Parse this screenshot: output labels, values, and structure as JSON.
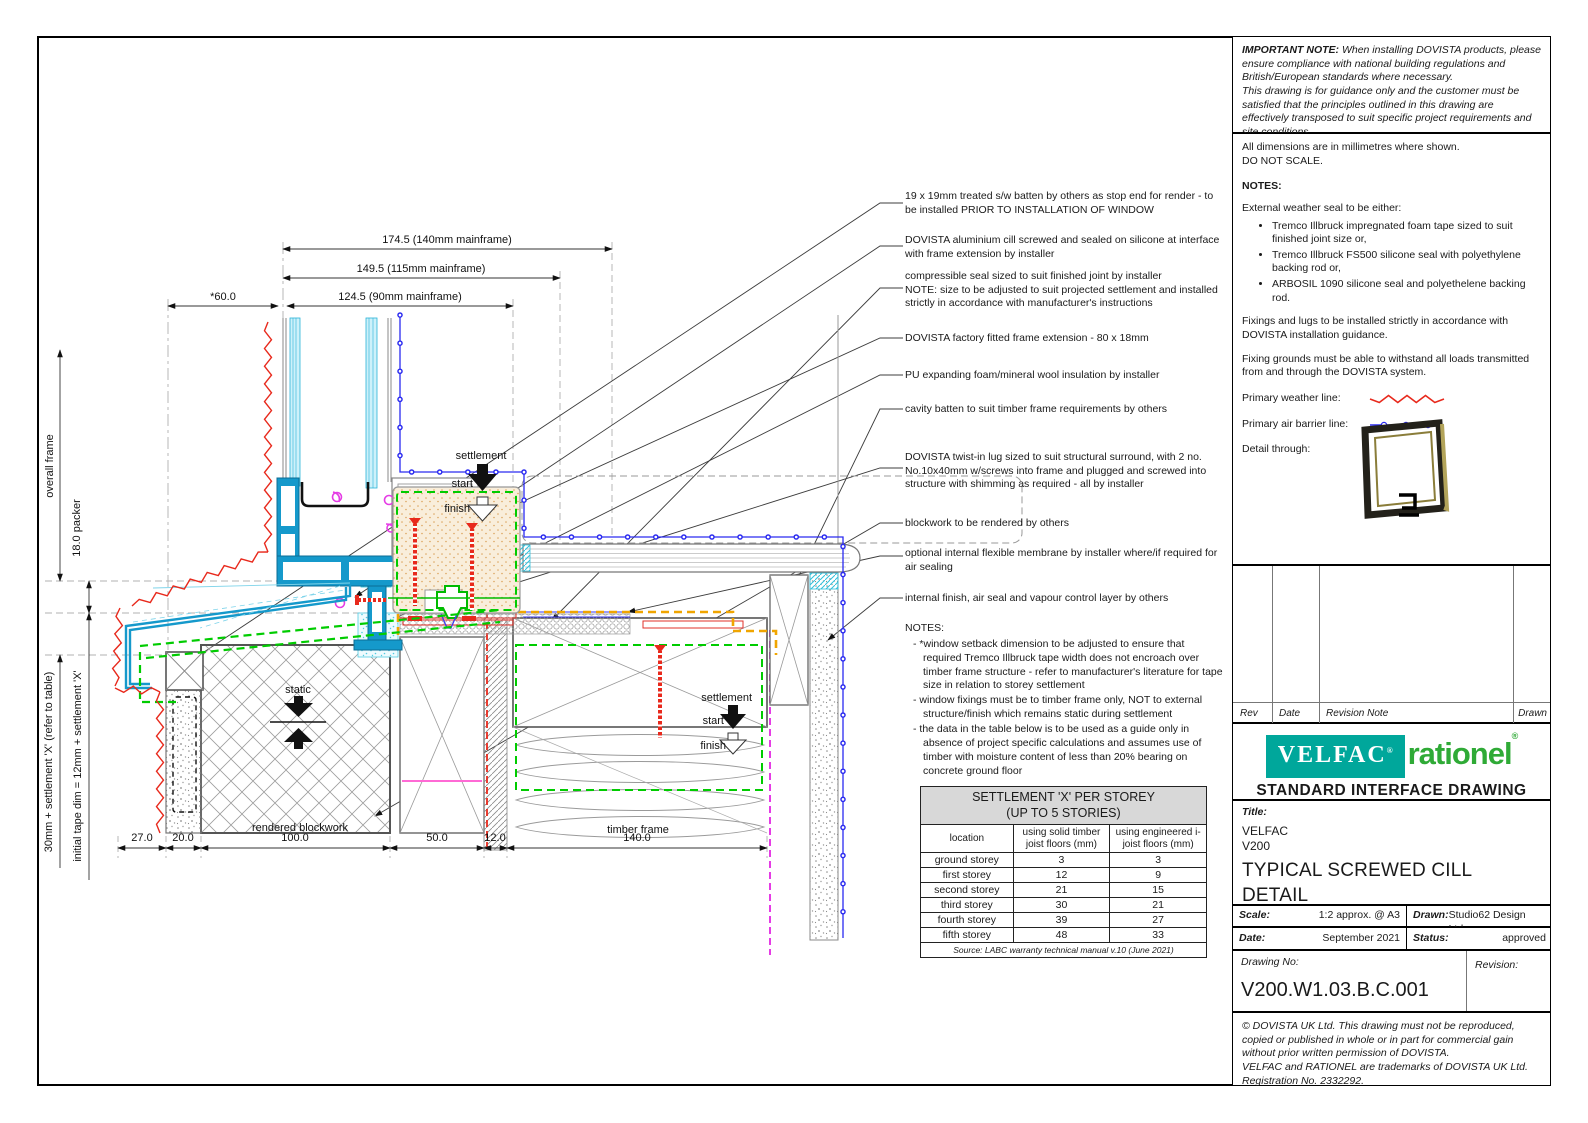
{
  "colors": {
    "velfac_teal": "#00a79b",
    "rationel_green": "#2faa36",
    "weather_red": "#e8291c",
    "air_blue": "#2a2af0",
    "seal_green": "#00cc00",
    "membrane_orange": "#f0a500",
    "frame_teal": "#1599cb",
    "magenta": "#e53ce5"
  },
  "important_note": {
    "label": "IMPORTANT NOTE:",
    "text1": "When installing DOVISTA products, please ensure compliance with national building regulations and British/European standards where necessary.",
    "text2": "This drawing is for guidance only and the customer must be satisfied that the principles outlined in this drawing are effectively transposed to suit specific project requirements and site conditions."
  },
  "general_notes": {
    "dims_note": "All dimensions are in millimetres where shown.",
    "do_not_scale": "DO NOT SCALE.",
    "notes_heading": "NOTES:",
    "weather_seal_intro": "External weather seal to be either:",
    "bullets": [
      "Tremco Illbruck impregnated foam tape sized to suit finished joint size or,",
      "Tremco Illbruck FS500 silicone seal with polyethylene backing rod or,",
      "ARBOSIL 1090 silicone seal and polyethelene backing rod."
    ],
    "fixings": "Fixings and lugs to be installed strictly in accordance with DOVISTA installation guidance.",
    "fixing_grounds": "Fixing grounds must be able to withstand all loads transmitted from and through the DOVISTA system.",
    "weather_line_label": "Primary weather line:",
    "air_line_label": "Primary air barrier line:",
    "detail_through_label": "Detail through:"
  },
  "revision_table": {
    "rev": "Rev",
    "date": "Date",
    "note": "Revision Note",
    "drawn": "Drawn"
  },
  "branding": {
    "velfac": "VELFAC",
    "reg": "®",
    "rationel": "rationel",
    "subtitle": "STANDARD INTERFACE DRAWING"
  },
  "title_block": {
    "title_label": "Title:",
    "product": "VELFAC",
    "series": "V200",
    "title_main": "TYPICAL SCREWED CILL DETAIL",
    "title_sub": "RENDERED BLOCK/ TIMBER FRAME",
    "scale_label": "Scale:",
    "scale": "1:2 approx. @ A3",
    "drawn_label": "Drawn:",
    "drawn": "Studio62 Design Ltd.",
    "date_label": "Date:",
    "date": "September 2021",
    "status_label": "Status:",
    "status": "approved",
    "drawing_no_label": "Drawing No:",
    "drawing_no": "V200.W1.03.B.C.001",
    "revision_label": "Revision:"
  },
  "copyright": {
    "line1": "© DOVISTA UK Ltd. This drawing must not be reproduced, copied or published in whole or in part for commercial gain without prior written permission of DOVISTA.",
    "line2": "VELFAC and RATIONEL are trademarks of DOVISTA UK Ltd. Registration No. 2332292."
  },
  "annotations": [
    "19 x 19mm treated s/w batten by others as stop end for render - to be installed PRIOR TO INSTALLATION OF WINDOW",
    "DOVISTA aluminium cill screwed and sealed on silicone at interface with frame extension by installer",
    "compressible seal sized to suit finished joint by installer\nNOTE: size to be adjusted to suit projected settlement and installed strictly in accordance with manufacturer's instructions",
    "DOVISTA factory fitted frame extension - 80 x 18mm",
    "PU expanding foam/mineral wool insulation by installer",
    "cavity batten to suit timber frame requirements by others",
    "DOVISTA twist-in lug sized to suit structural surround, with 2 no. No.10x40mm w/screws into frame and plugged and screwed into structure with shimming as required - all by installer",
    "blockwork to be rendered by others",
    "optional internal flexible membrane by installer where/if required for air sealing",
    "internal finish, air seal and vapour control layer by others"
  ],
  "drawing_notes": {
    "heading": "NOTES:",
    "items": [
      "*window setback dimension to be adjusted to ensure that required Tremco Illbruck tape width does not encroach over timber frame structure - refer to manufacturer's literature for tape size in relation to storey settlement",
      "window fixings must be to timber frame only, NOT to external structure/finish which remains static during settlement",
      "the data in the table below is to be used as a guide only in absence of project specific calculations and assumes use of timber with moisture content of less than 20% bearing on concrete ground floor"
    ]
  },
  "settlement_table": {
    "title_line1": "SETTLEMENT 'X' PER STOREY",
    "title_line2": "(UP TO 5 STORIES)",
    "col_location": "location",
    "col_solid": "using solid timber joist floors (mm)",
    "col_engineered": "using engineered i-joist floors (mm)",
    "rows": [
      {
        "location": "ground storey",
        "solid": "3",
        "engineered": "3"
      },
      {
        "location": "first storey",
        "solid": "12",
        "engineered": "9"
      },
      {
        "location": "second storey",
        "solid": "21",
        "engineered": "15"
      },
      {
        "location": "third storey",
        "solid": "30",
        "engineered": "21"
      },
      {
        "location": "fourth storey",
        "solid": "39",
        "engineered": "27"
      },
      {
        "location": "fifth storey",
        "solid": "48",
        "engineered": "33"
      }
    ],
    "source": "Source: LABC warranty technical manual v.10 (June 2021)"
  },
  "dims": {
    "top": [
      "174.5 (140mm mainframe)",
      "149.5 (115mm mainframe)",
      "124.5 (90mm mainframe)",
      "*60.0"
    ],
    "bottom": [
      "27.0",
      "20.0",
      "100.0",
      "50.0",
      "12.0",
      "140.0"
    ],
    "left_overall": "overall frame",
    "left_packer": "18.0 packer",
    "left_settlement": "30mm + settlement 'X' (refer to table)",
    "left_tape": "initial tape dim = 12mm + settlement 'X'"
  },
  "drawing_labels": {
    "settlement": "settlement",
    "start": "start",
    "finish": "finish",
    "static": "static",
    "rendered_blockwork": "rendered blockwork",
    "timber_frame": "timber frame"
  }
}
